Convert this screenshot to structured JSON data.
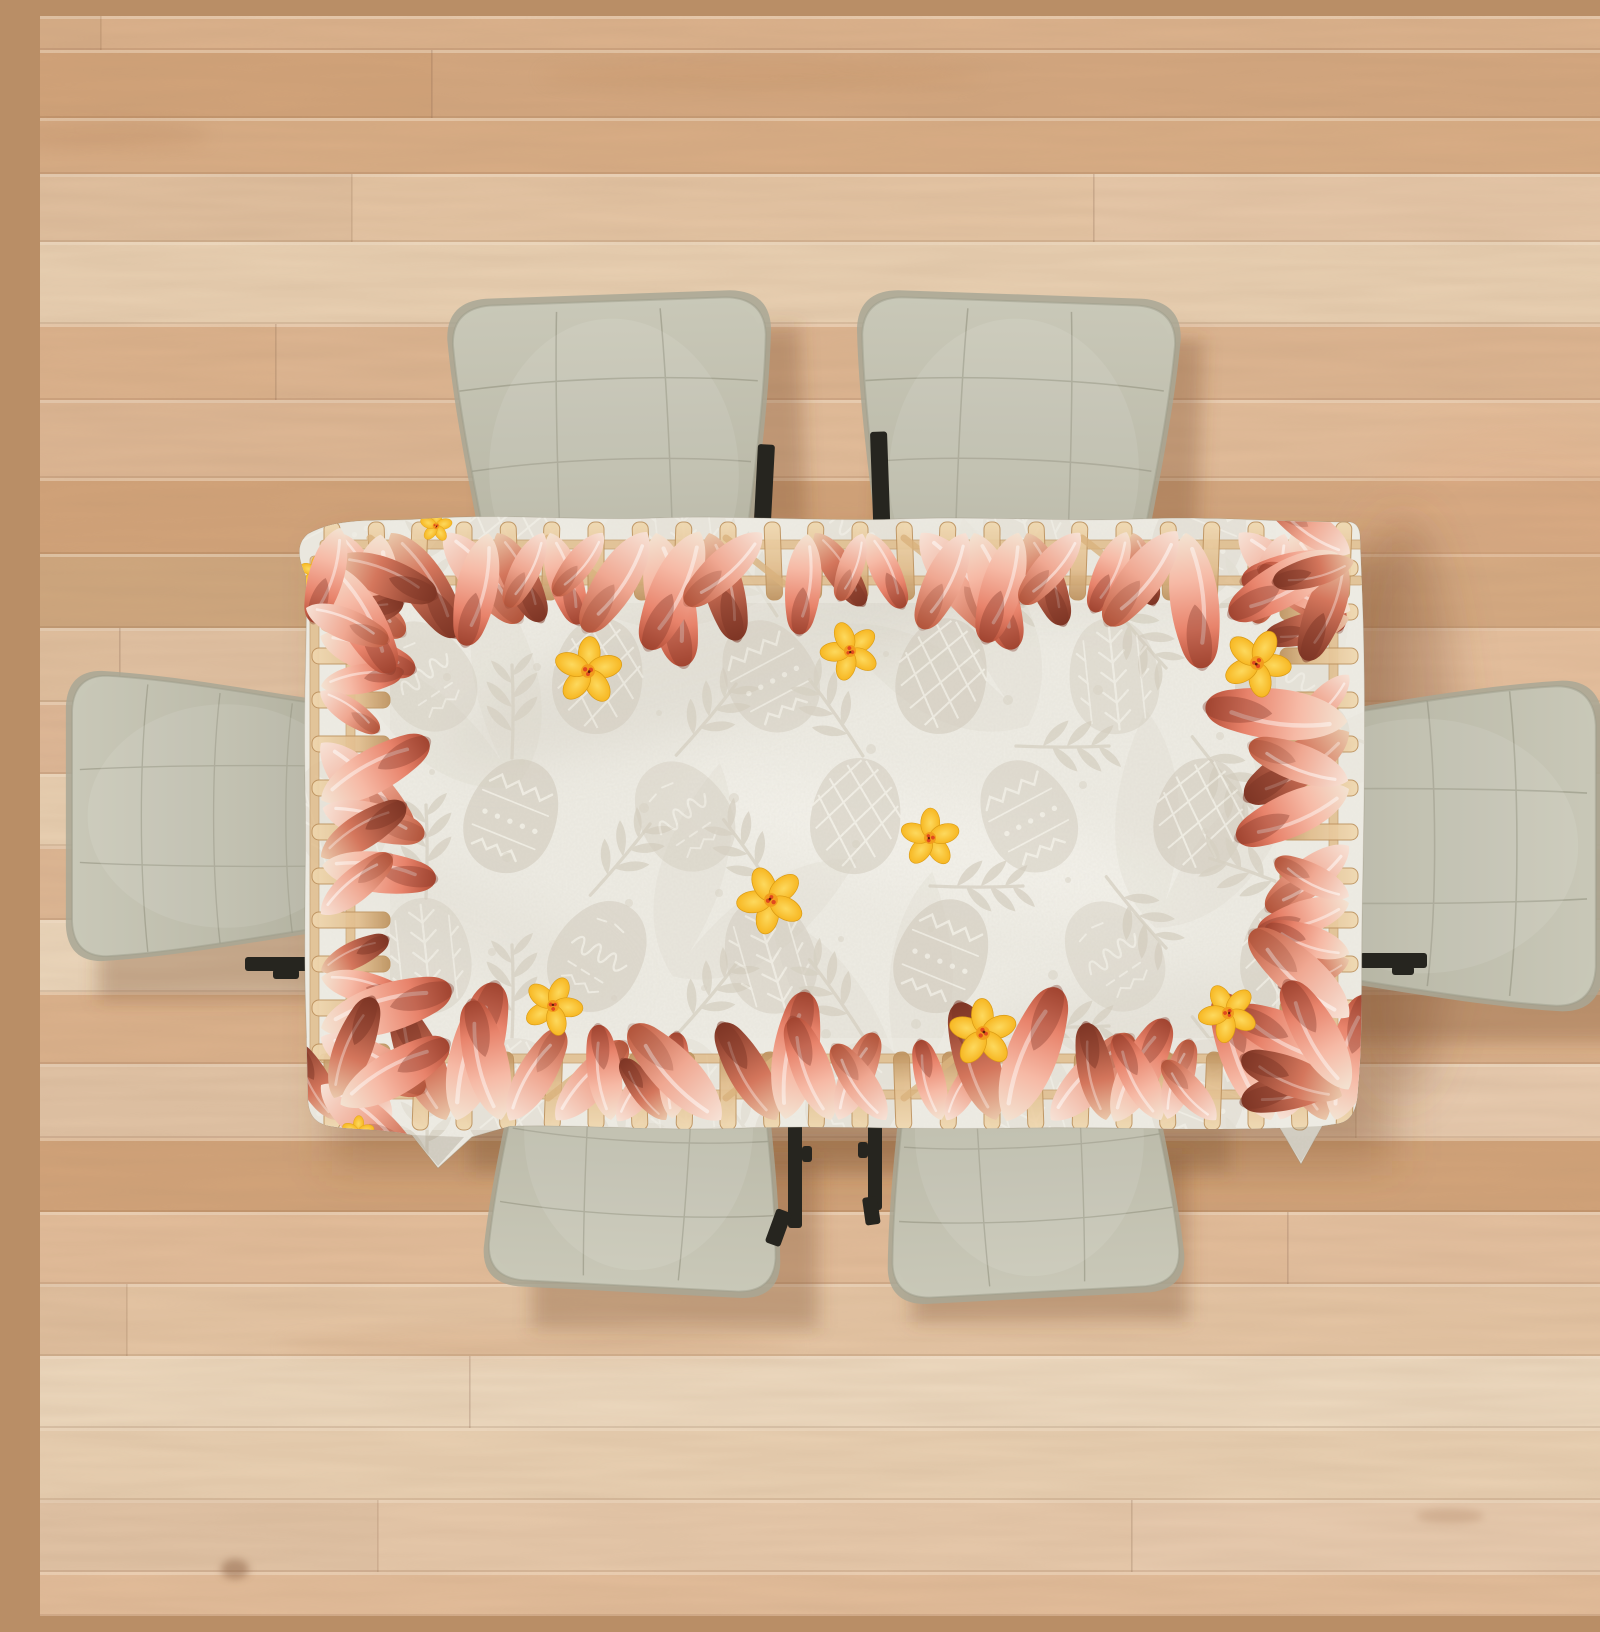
{
  "scene": {
    "description": "Top-down view of a rectangular dining table covered with a white Easter tablecloth, surrounded by six sage-green upholstered chairs on a light oak wood plank floor",
    "floor": {
      "label": "light oak wood plank floor",
      "plank_orientation": "horizontal"
    },
    "tablecloth": {
      "label": "easter tablecloth",
      "style": "watercolor",
      "motifs": [
        "patterned easter eggs",
        "easter script egg",
        "leaf sprigs",
        "polka dots",
        "yellow daffodil flowers",
        "watercolor bunny ears",
        "wooden picket fence border"
      ],
      "border": "bunny ears peeking over a wooden fence on all four edges",
      "flower_positions": [
        [
          548,
          655
        ],
        [
          810,
          635
        ],
        [
          1217,
          647
        ],
        [
          890,
          822
        ],
        [
          731,
          884
        ],
        [
          513,
          990
        ],
        [
          943,
          1017
        ],
        [
          1188,
          997
        ]
      ],
      "border_accent_positions": [
        [
          276,
          556
        ],
        [
          396,
          510
        ],
        [
          318,
          1116
        ]
      ]
    },
    "chairs": {
      "count": 6,
      "style": "quilted upholstered chairs with black metal frames, seen from above",
      "items": [
        {
          "id": "chair-top-left",
          "x": 575,
          "y": 485,
          "rotation": -2,
          "scale": 0.96
        },
        {
          "id": "chair-top-right",
          "x": 973,
          "y": 485,
          "rotation": 2,
          "scale": 0.96
        },
        {
          "id": "chair-right",
          "x": 1352,
          "y": 830,
          "rotation": 90,
          "scale": 0.98
        },
        {
          "id": "chair-bottom-right",
          "x": 988,
          "y": 1093,
          "rotation": 177,
          "scale": 0.88
        },
        {
          "id": "chair-bottom-left",
          "x": 600,
          "y": 1087,
          "rotation": 183,
          "scale": 0.88
        },
        {
          "id": "chair-left",
          "x": 211,
          "y": 800,
          "rotation": -90,
          "scale": 0.86
        }
      ]
    }
  },
  "colors": {
    "floor_base": "#ddb592",
    "floor_light": "#ead3b7",
    "floor_dark": "#cfa076",
    "seam": "#c89b73",
    "cloth": "#eeece4",
    "cloth_shade": "#d7d2c5",
    "egg": "#d3ccbe",
    "egg_line": "#f6f3ea",
    "leaf": "#d8d2c4",
    "fence_light": "#f0d6ab",
    "fence_mid": "#e0b985",
    "fence_dark": "#b98a52",
    "ear_cream": "#f3e3d2",
    "ear_light": "#f6b9a5",
    "ear_mid": "#e8836b",
    "ear_dark": "#b14a33",
    "ear_deep": "#7e3526",
    "flower": "#f7b722",
    "flower_light": "#fdd95e",
    "flower_center": "#e0491f",
    "chair": "#bcbbaa",
    "chair_light": "#c9c8b8",
    "chair_dark": "#a8a795",
    "chair_stitch": "#9e9d8b",
    "metal": "#26251f",
    "shadow": "rgba(130,85,50,0.40)"
  }
}
